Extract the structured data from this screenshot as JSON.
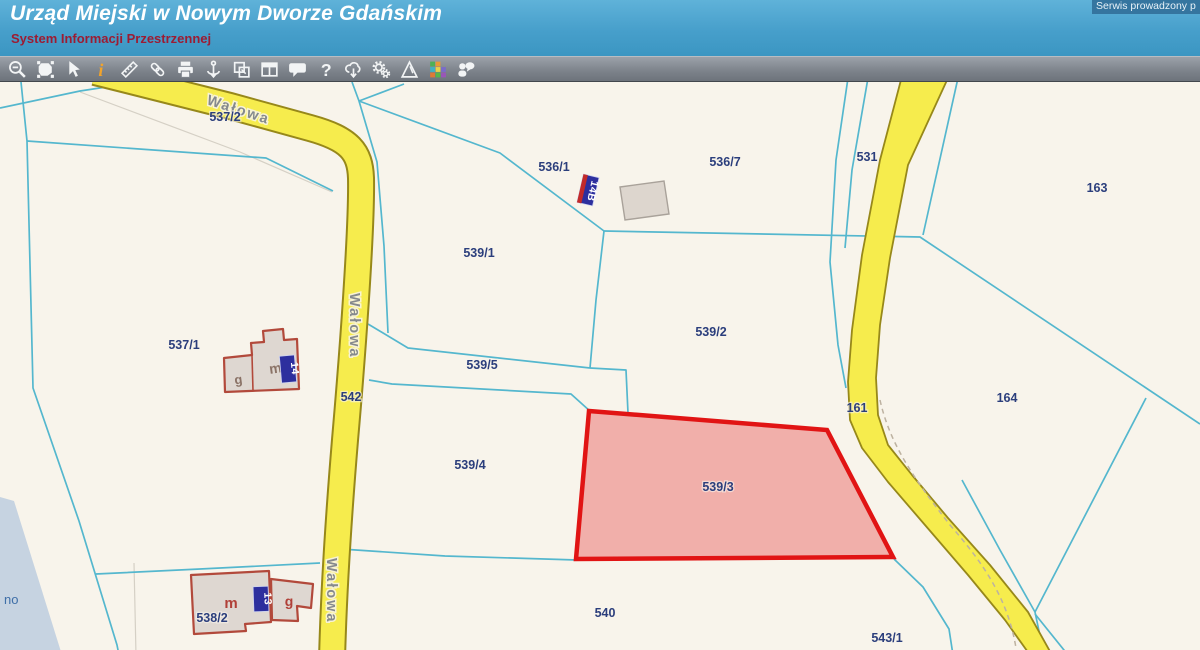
{
  "header": {
    "title": "Urząd Miejski w Nowym Dworze Gdańskim",
    "subtitle": "System Informacji Przestrzennej",
    "service_note": "Serwis prowadzony p"
  },
  "toolbar": {
    "icons": [
      "zoom-out-icon",
      "polygon-select-icon",
      "cursor-icon",
      "info-icon",
      "measure-icon",
      "link-icon",
      "print-icon",
      "anchor-icon",
      "overlap-windows-icon",
      "layout-panels-icon",
      "speech-bubble-icon",
      "help-icon",
      "cloud-download-icon",
      "gears-icon",
      "pyramid-icon",
      "color-grid-icon",
      "person-speech-icon"
    ]
  },
  "map": {
    "selected_parcel": "539/3",
    "street_name": "Wałowa",
    "street_labels": [
      {
        "text": "Wałowa",
        "x": 206,
        "y": 104,
        "rot": 18
      },
      {
        "text": "Wałowa",
        "x": 350,
        "y": 293,
        "rot": 90
      },
      {
        "text": "Wałowa",
        "x": 327,
        "y": 558,
        "rot": 90
      }
    ],
    "parcel_labels": [
      {
        "text": "537/2",
        "x": 225,
        "y": 121
      },
      {
        "text": "536/1",
        "x": 554,
        "y": 171
      },
      {
        "text": "536/7",
        "x": 725,
        "y": 166
      },
      {
        "text": "531",
        "x": 867,
        "y": 161
      },
      {
        "text": "163",
        "x": 1097,
        "y": 192
      },
      {
        "text": "539/1",
        "x": 479,
        "y": 257
      },
      {
        "text": "539/2",
        "x": 711,
        "y": 336
      },
      {
        "text": "537/1",
        "x": 184,
        "y": 349
      },
      {
        "text": "539/5",
        "x": 482,
        "y": 369
      },
      {
        "text": "542",
        "x": 351,
        "y": 401
      },
      {
        "text": "161",
        "x": 857,
        "y": 412
      },
      {
        "text": "164",
        "x": 1007,
        "y": 402
      },
      {
        "text": "539/4",
        "x": 470,
        "y": 469
      },
      {
        "text": "539/3",
        "x": 718,
        "y": 491
      },
      {
        "text": "540",
        "x": 605,
        "y": 617
      },
      {
        "text": "538/2",
        "x": 212,
        "y": 622
      },
      {
        "text": "543/1",
        "x": 887,
        "y": 642
      }
    ],
    "building_labels": [
      {
        "text": "m",
        "x": 276,
        "y": 373,
        "color": "#8a7266",
        "size": 14,
        "rot": -8
      },
      {
        "text": "g",
        "x": 239,
        "y": 384,
        "color": "#8a7266",
        "size": 13,
        "rot": -8
      },
      {
        "text": "m",
        "x": 231,
        "y": 608,
        "color": "#b04038",
        "size": 15,
        "rot": 0
      },
      {
        "text": "g",
        "x": 289,
        "y": 606,
        "color": "#b04038",
        "size": 14,
        "rot": 0
      }
    ],
    "address_plates": [
      {
        "text": "14B",
        "x": 588,
        "y": 190,
        "rot": 13,
        "w": 16,
        "h": 29,
        "stripe": true
      },
      {
        "text": "14",
        "x": 288,
        "y": 369,
        "rot": -5,
        "w": 15,
        "h": 27,
        "stripe": false
      },
      {
        "text": "13",
        "x": 261,
        "y": 599,
        "rot": -2,
        "w": 15,
        "h": 25,
        "stripe": false
      }
    ],
    "water_label": {
      "text": "no",
      "x": 4,
      "y": 604
    },
    "colors": {
      "background": "#f8f4eb",
      "parcel_line": "#54b7ce",
      "road_fill": "#f6ec4d",
      "road_casing": "#97881a",
      "selected_stroke": "#e11414",
      "selected_fill": "#e96a6a",
      "parcel_label": "#2b3e7c",
      "street_label": "#85898d",
      "water": "#c6d3e1",
      "building_fill": "#ded7d1",
      "building_stroke": "#b2493b",
      "plate_bg": "#2d2f9e",
      "plate_stripe": "#c22a2a"
    }
  }
}
